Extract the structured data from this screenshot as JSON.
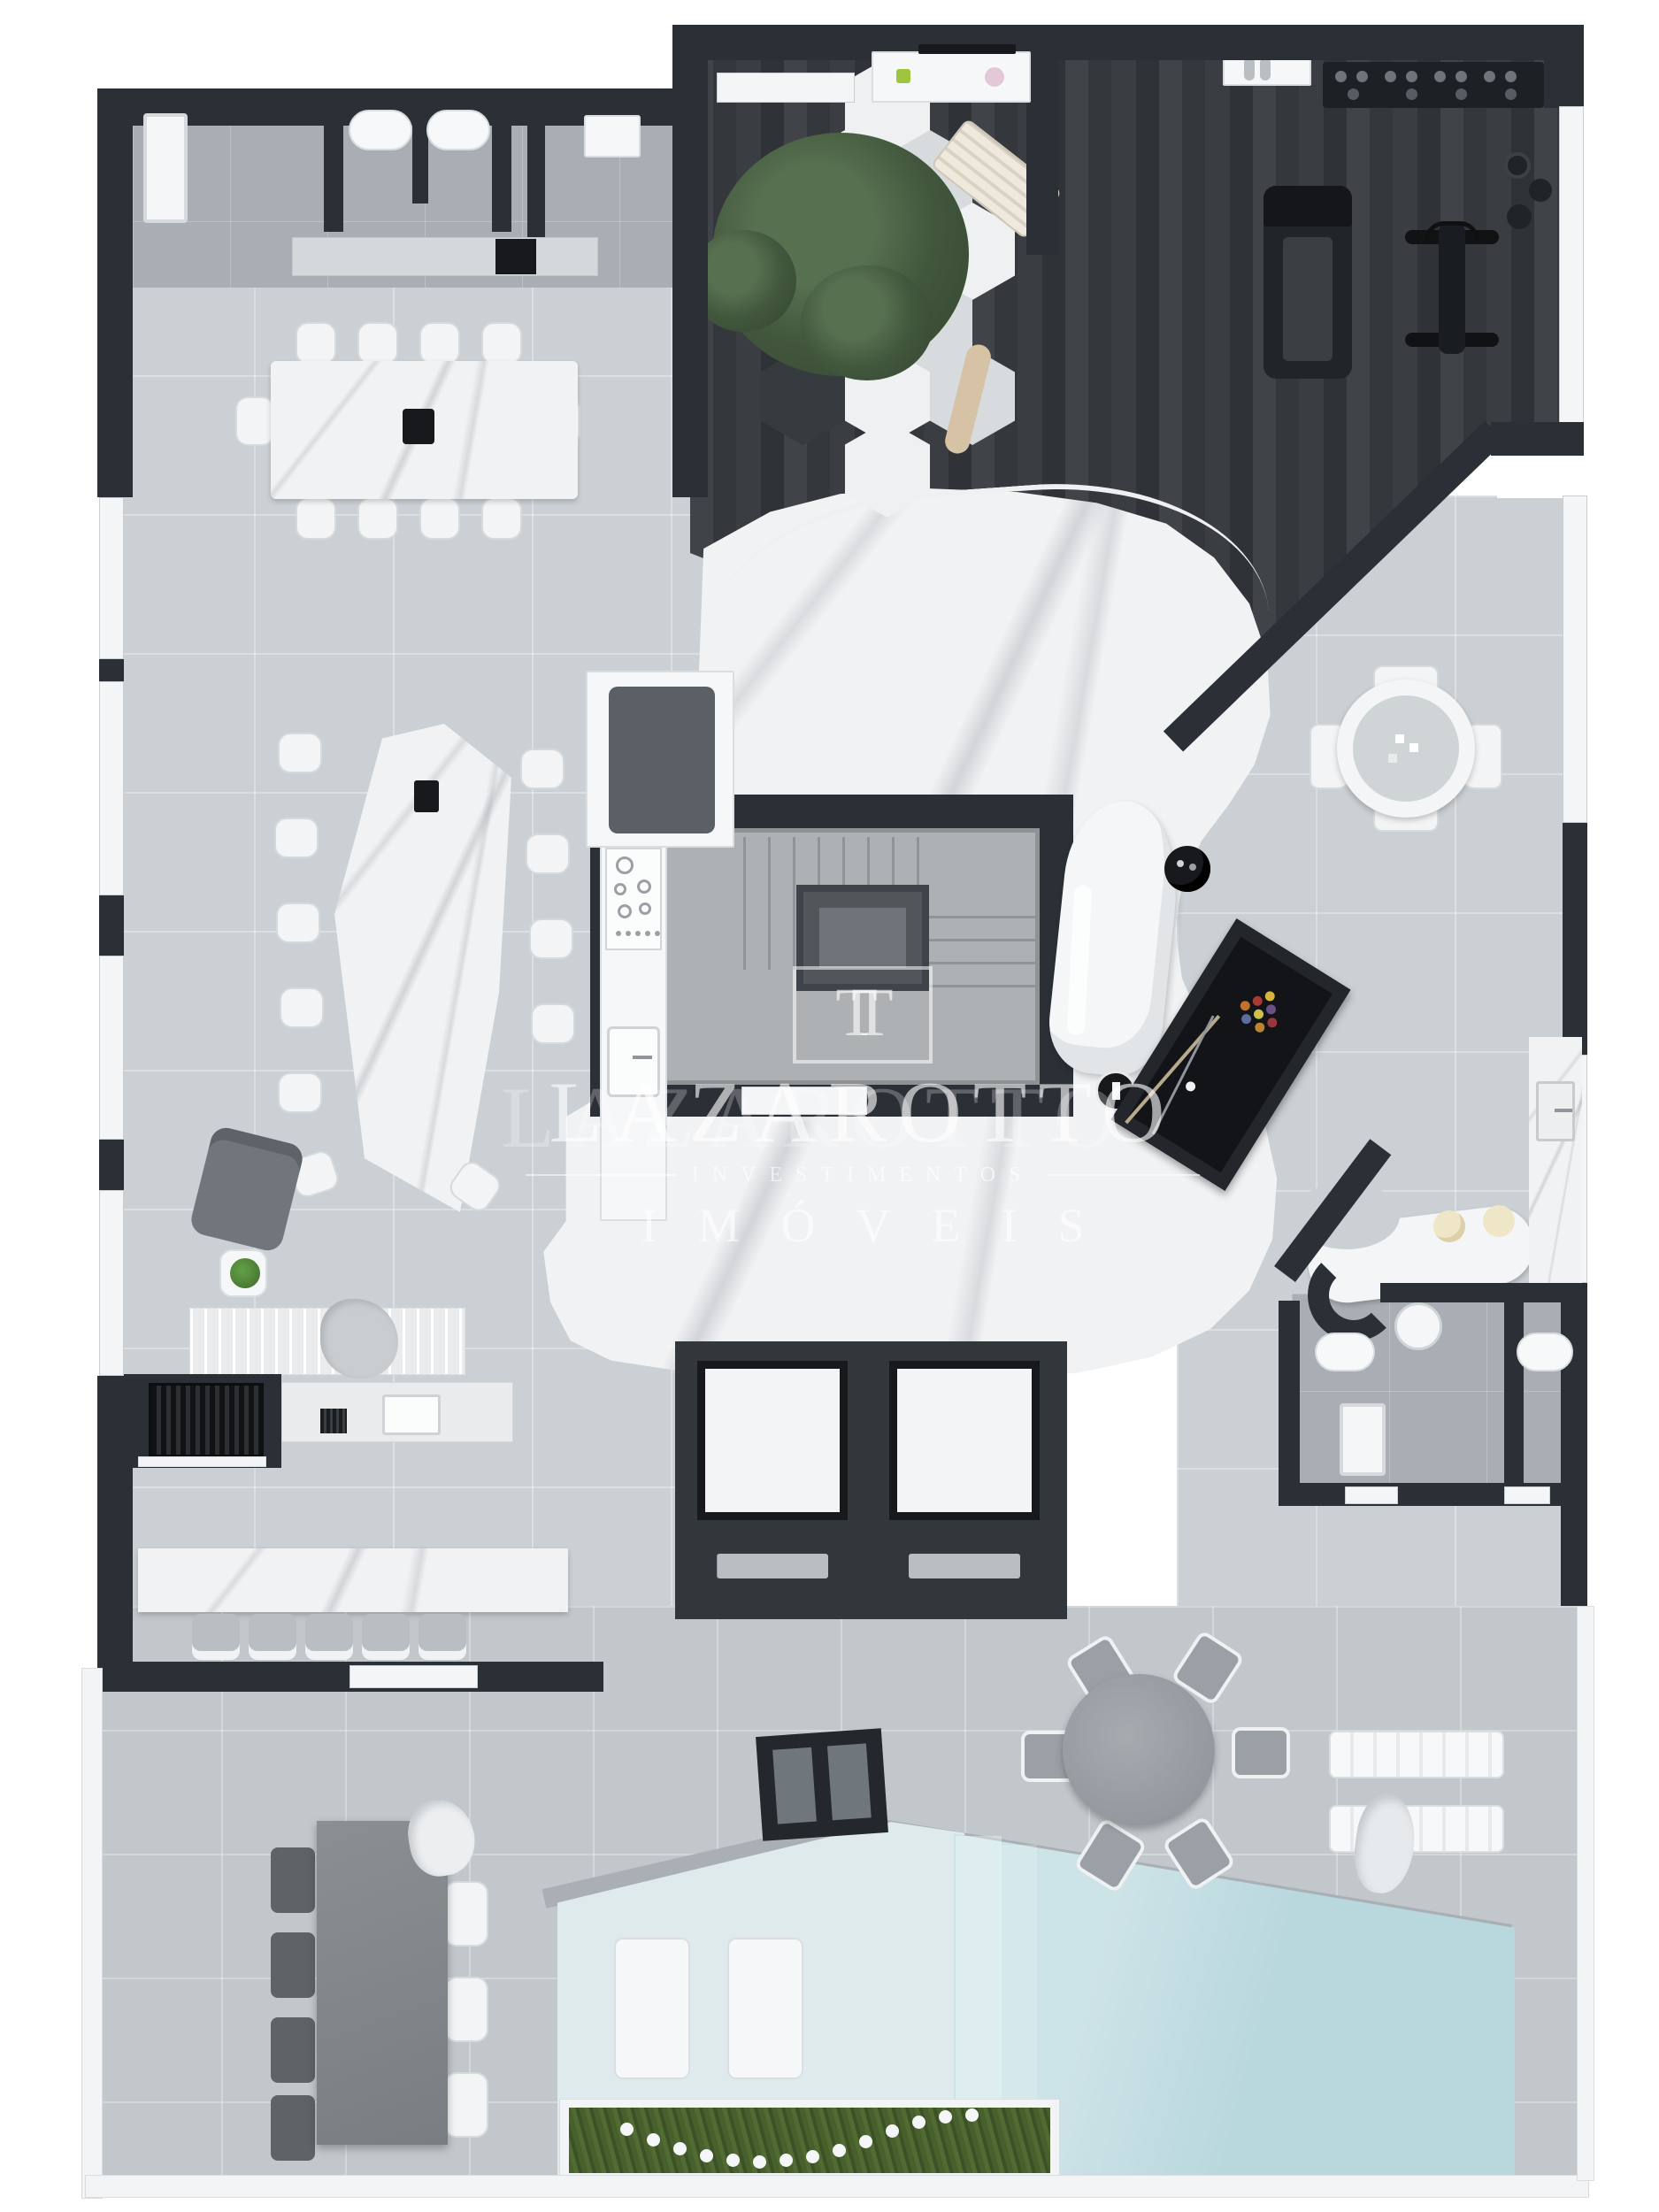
{
  "watermark": {
    "logo_monogram": "TT",
    "name": "LAZAROTTO",
    "subtitle": "INVESTIMENTOS",
    "tagline": "IMÓVEIS"
  },
  "palette": {
    "wall": "#2b3036",
    "black": "#17191c",
    "tileLight": "#cad0d4",
    "terrace": "#c1c7cb",
    "bathFloor": "#a8aeb4",
    "marble": "#f1f2f4",
    "concrete": "#aeb1b3",
    "woodDark": "#383c40",
    "poolMain": "#b9d8de",
    "poolPale": "#dfeaec",
    "coping": "#a9afb4",
    "grass": "#4a6430",
    "treeGreen": "#42573d",
    "cream": "#efe6c8",
    "white": "#f6f7f8"
  },
  "zones": [
    {
      "name": "restrooms",
      "objects": [
        "shower",
        "toilet",
        "toilet",
        "vanity-counter",
        "black-cosmetics-tray"
      ]
    },
    {
      "name": "dining-room",
      "objects": [
        "marble-dining-table",
        "10-white-chairs",
        "black-centerpiece"
      ]
    },
    {
      "name": "winter-garden",
      "objects": [
        "hexagonal-tiles",
        "tree",
        "wood-lounger",
        "driftwood",
        "decor-shelf"
      ]
    },
    {
      "name": "gym",
      "objects": [
        "dumbbell-rack",
        "treadmill",
        "exercise-bike",
        "weight-plates",
        "shoe-shelf",
        "dark-wood-floor"
      ]
    },
    {
      "name": "lounge",
      "objects": [
        "hexagonal-marble-table",
        "11-white-chairs",
        "gray-armchair",
        "plant-side-table",
        "ribbed-sideboard",
        "blanket"
      ]
    },
    {
      "name": "kitchen",
      "objects": [
        "gas-cooktop",
        "sink",
        "tall-cabinet"
      ]
    },
    {
      "name": "stairwell",
      "objects": [
        "stair-flights",
        "central-void"
      ]
    },
    {
      "name": "hall",
      "objects": [
        "white-marble-floor",
        "curved-chaise",
        "round-black-side-table",
        "round-black-coffee-table"
      ]
    },
    {
      "name": "games-area",
      "objects": [
        "billiards-table",
        "ball-triangle",
        "cue-sticks",
        "round-table-4-chairs"
      ]
    },
    {
      "name": "bar",
      "objects": [
        "curved-counter",
        "2-cream-stools",
        "L-counter-with-sink"
      ]
    },
    {
      "name": "bathrooms",
      "objects": [
        "toilet",
        "toilet",
        "round-sink",
        "shower-tray",
        "curved-wall"
      ]
    },
    {
      "name": "elevators",
      "objects": [
        "elevator-cab",
        "elevator-cab"
      ]
    },
    {
      "name": "gourmet-area",
      "objects": [
        "built-in-grill",
        "counter-with-sink",
        "marble-bar-counter",
        "5-stools"
      ]
    },
    {
      "name": "terrace",
      "objects": [
        "round-table-6-chairs",
        "2-sun-loungers",
        "towel",
        "concrete-table",
        "4-dark-chairs",
        "3-white-chairs",
        "glass-railing"
      ]
    },
    {
      "name": "pool",
      "objects": [
        "wet-deck",
        "2-in-water-loungers",
        "main-pool",
        "steps",
        "dark-spa-wall",
        "planter-with-string-lights"
      ]
    }
  ]
}
